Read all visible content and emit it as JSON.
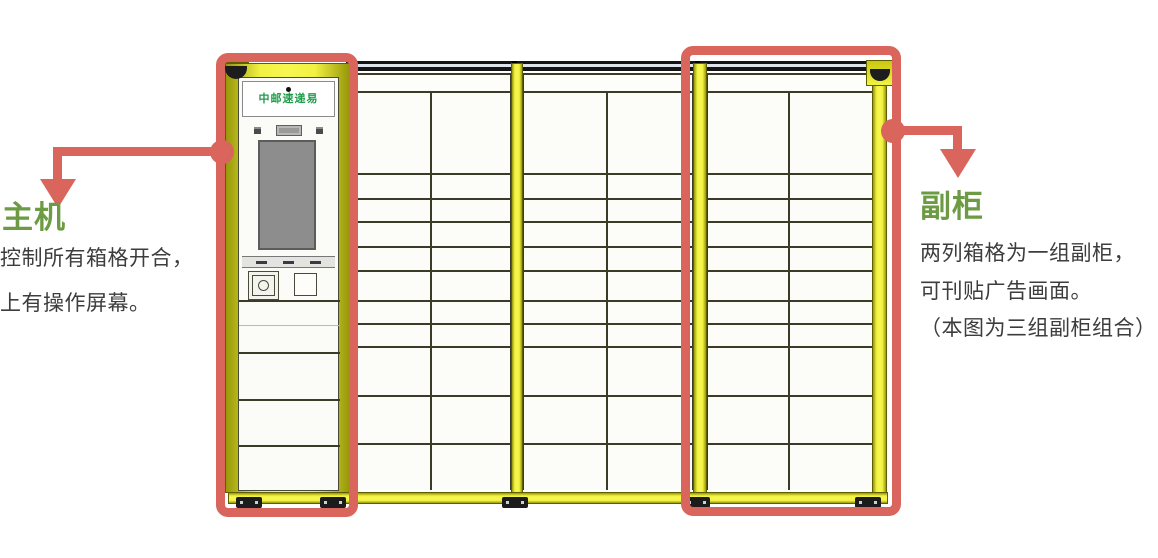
{
  "diagram": {
    "brand": "中邮速递易",
    "annotations": {
      "main_unit": {
        "title": "主机",
        "lines": [
          "控制所有箱格开合，",
          "上有操作屏幕。"
        ]
      },
      "sub_cabinet": {
        "title": "副柜",
        "lines": [
          "两列箱格为一组副柜，",
          "可刊贴广告画面。",
          "（本图为三组副柜组合）"
        ]
      }
    },
    "locker": {
      "group_count": 3,
      "columns_per_group": 2,
      "door_rows_per_column": 11
    },
    "colors": {
      "highlight_red": "#d9655c",
      "heading_green": "#6d9b44",
      "brand_green": "#1f9d4b",
      "frame_yellow": "#f2f243",
      "grid_line": "#3b3b28"
    }
  }
}
